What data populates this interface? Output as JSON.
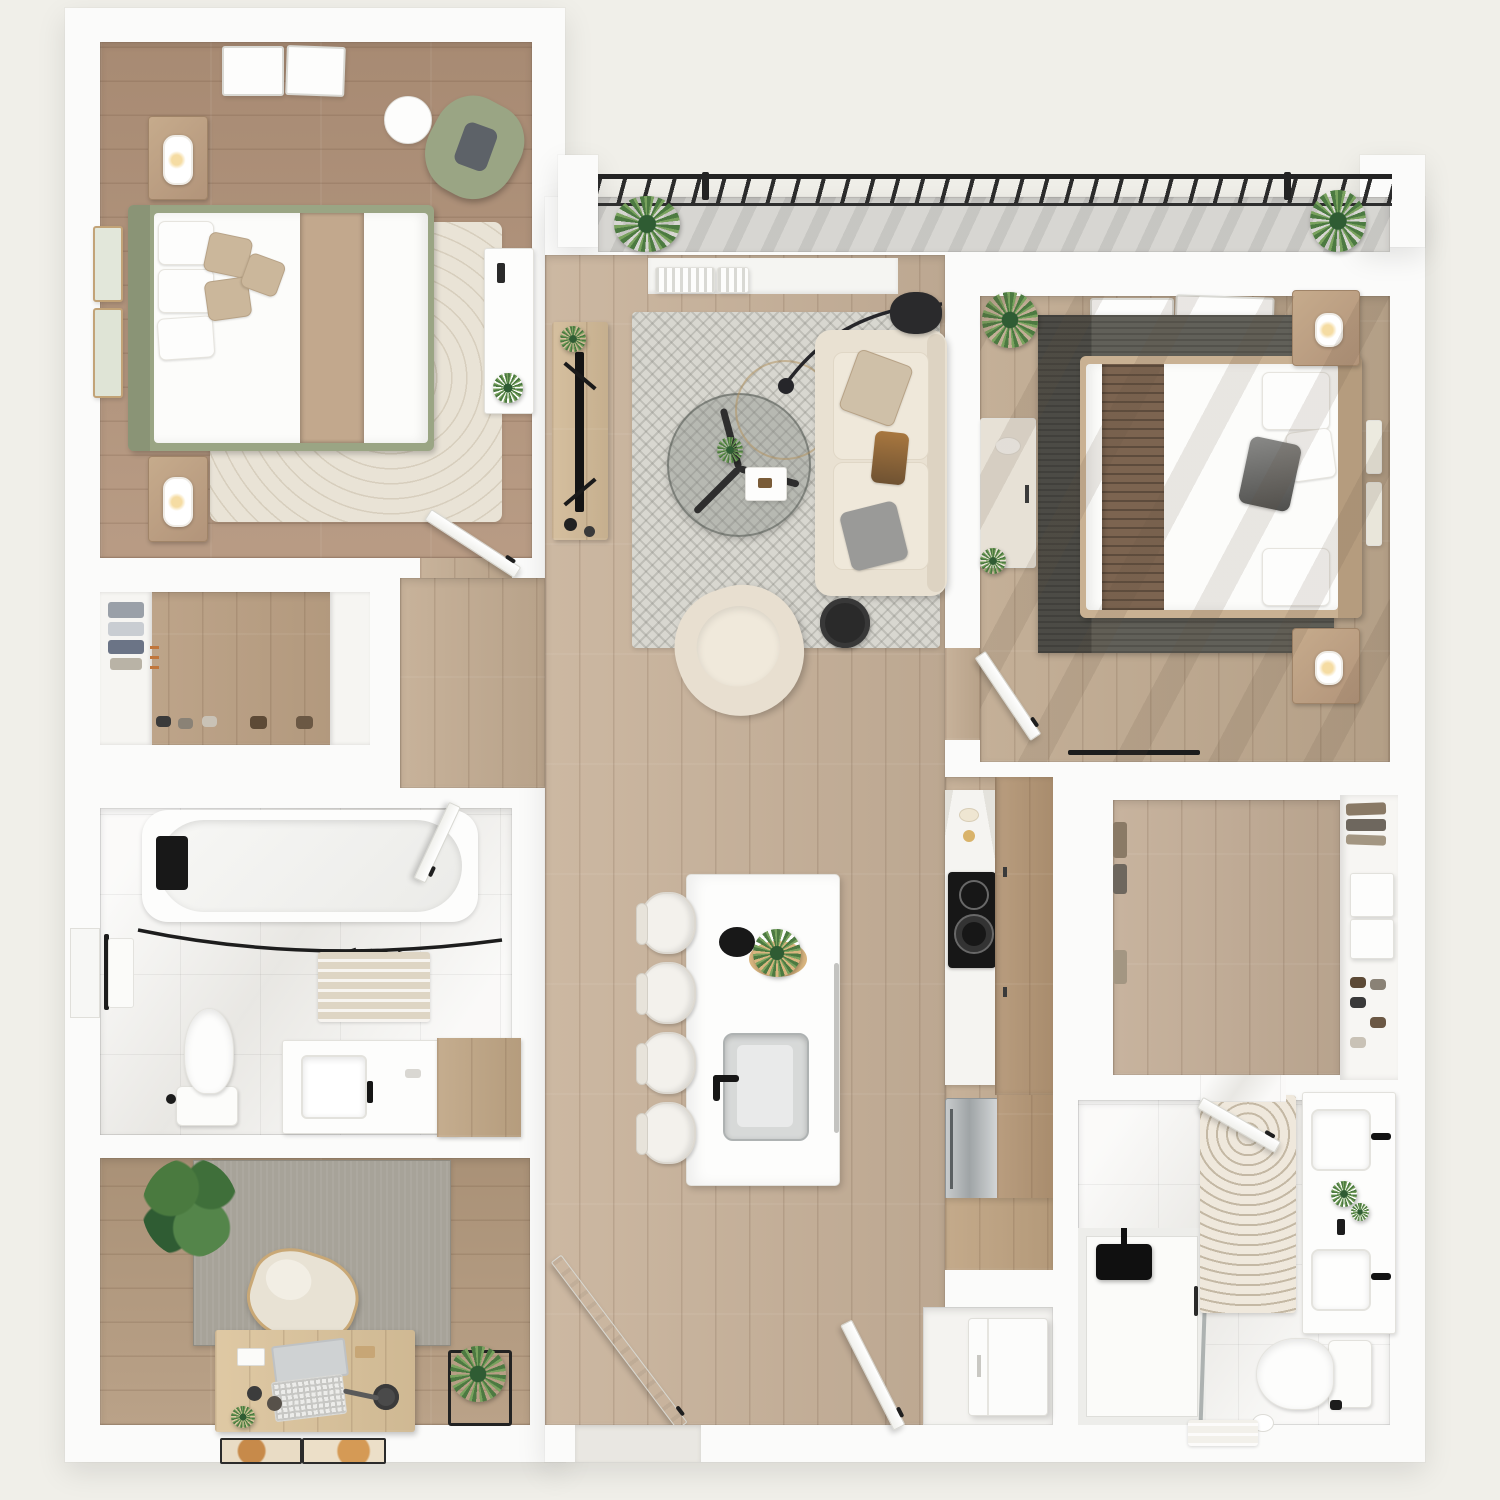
{
  "meta": {
    "title": "3D apartment floor plan, top-down view",
    "style": "photoreal render, white walls, wood floors"
  },
  "colors": {
    "background": "#f0efe9",
    "wall": "#fbfbfa",
    "tile": "#f3f2ef",
    "concrete": "#d7d6d2",
    "railing": "#2b2b2b",
    "wood_a": "#b2937a",
    "wood_b": "#c8b29a",
    "wood_light": "#dcc49c",
    "rug_bed1": "#e9e3d6",
    "rug_living": "#d8d7d0",
    "rug_bed2": "#616059",
    "rug_office": "#a7a399",
    "sage": "#9aa584",
    "cream": "#e9e1d2",
    "tan": "#c9b193",
    "brown_runner": "#7c6450",
    "blanket": "#c2a88d",
    "plant_dark": "#2f5c33",
    "plant_mid": "#4c7a41",
    "plant_light": "#79a25e",
    "black": "#1f1f1f",
    "stainless": "#b9bcbd",
    "brass": "#b39363",
    "glass": "#8d938f"
  },
  "rooms": [
    {
      "id": "bedroom-1",
      "label": "Bedroom 1"
    },
    {
      "id": "living-room",
      "label": "Living room, kitchen and entry (open plan)"
    },
    {
      "id": "bedroom-2",
      "label": "Bedroom 2"
    },
    {
      "id": "closet-1",
      "label": "Closet with shelves and shoes"
    },
    {
      "id": "hallway",
      "label": "Hallway"
    },
    {
      "id": "bathroom-1",
      "label": "Bathroom 1 with tub"
    },
    {
      "id": "office",
      "label": "Office / den"
    },
    {
      "id": "kitchen-run",
      "label": "Kitchen counter run"
    },
    {
      "id": "walk-in",
      "label": "Walk-in closet"
    },
    {
      "id": "bathroom-2",
      "label": "Bathroom 2 with shower"
    },
    {
      "id": "laundry",
      "label": "Laundry closet"
    },
    {
      "id": "balcony",
      "label": "Balcony"
    }
  ]
}
